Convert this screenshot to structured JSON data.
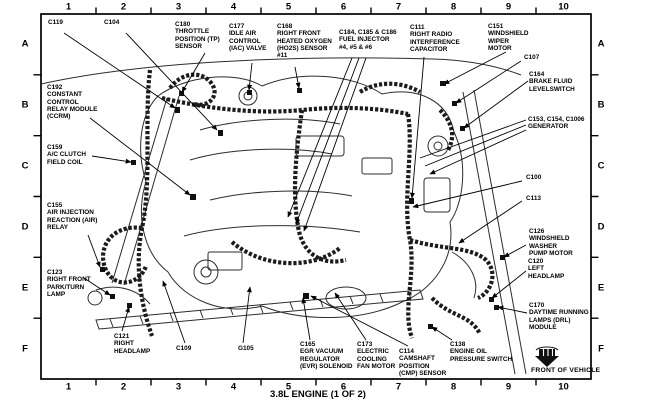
{
  "title": "3.8L ENGINE (1 OF 2)",
  "front_of_vehicle_label": "FRONT OF VEHICLE",
  "colors": {
    "ink": "#000000",
    "background": "#ffffff"
  },
  "grid": {
    "columns": [
      "1",
      "2",
      "3",
      "4",
      "5",
      "6",
      "7",
      "8",
      "9",
      "10"
    ],
    "rows": [
      "A",
      "B",
      "C",
      "D",
      "E",
      "F"
    ]
  },
  "callouts": [
    {
      "id": "c119",
      "text": "C119",
      "x": 48,
      "y": 19
    },
    {
      "id": "c104",
      "text": "C104",
      "x": 104,
      "y": 19
    },
    {
      "id": "c180",
      "text": "C180\nTHROTTLE\nPOSITION (TP)\nSENSOR",
      "x": 175,
      "y": 21
    },
    {
      "id": "c177",
      "text": "C177\nIDLE AIR\nCONTROL\n(IAC) VALVE",
      "x": 229,
      "y": 23
    },
    {
      "id": "c168",
      "text": "C168\nRIGHT FRONT\nHEATED OXYGEN\n(HO2S) SENSOR\n#11",
      "x": 277,
      "y": 23
    },
    {
      "id": "c184-c186",
      "text": "C184, C185 & C186\nFUEL INJECTOR\n#4, #5 & #6",
      "x": 339,
      "y": 29
    },
    {
      "id": "c111",
      "text": "C111\nRIGHT RADIO\nINTERFERENCE\nCAPACITOR",
      "x": 410,
      "y": 24
    },
    {
      "id": "c151",
      "text": "C151\nWINDSHIELD\nWIPER\nMOTOR",
      "x": 488,
      "y": 23
    },
    {
      "id": "c107",
      "text": "C107",
      "x": 524,
      "y": 54
    },
    {
      "id": "c164",
      "text": "C164\nBRAKE FLUID\nLEVELSWITCH",
      "x": 529,
      "y": 71
    },
    {
      "id": "c153-c1006",
      "text": "C153, C154, C1006\nGENERATOR",
      "x": 528,
      "y": 116
    },
    {
      "id": "c100",
      "text": "C100",
      "x": 526,
      "y": 174
    },
    {
      "id": "c113",
      "text": "C113",
      "x": 526,
      "y": 195
    },
    {
      "id": "c126",
      "text": "C126\nWINDSHIELD\nWASHER\nPUMP MOTOR",
      "x": 529,
      "y": 228
    },
    {
      "id": "c120",
      "text": "C120\nLEFT\nHEADLAMP",
      "x": 528,
      "y": 258
    },
    {
      "id": "c170",
      "text": "C170\nDAYTIME RUNNING\nLAMPS (DRL)\nMODULE",
      "x": 529,
      "y": 302
    },
    {
      "id": "c192",
      "text": "C192\nCONSTANT\nCONTROL\nRELAY MODULE\n(CCRM)",
      "x": 47,
      "y": 84
    },
    {
      "id": "c159",
      "text": "C159\nA/C CLUTCH\nFIELD COIL",
      "x": 47,
      "y": 144
    },
    {
      "id": "c155",
      "text": "C155\nAIR INJECTION\nREACTION (AIR)\nRELAY",
      "x": 47,
      "y": 202
    },
    {
      "id": "c123",
      "text": "C123\nRIGHT FRONT\nPARK/TURN\nLAMP",
      "x": 47,
      "y": 269
    },
    {
      "id": "c121",
      "text": "C121\nRIGHT\nHEADLAMP",
      "x": 114,
      "y": 333
    },
    {
      "id": "c109",
      "text": "C109",
      "x": 176,
      "y": 345
    },
    {
      "id": "g105",
      "text": "G105",
      "x": 238,
      "y": 345
    },
    {
      "id": "c165",
      "text": "C165\nEGR VACUUM\nREGULATOR\n(EVR) SOLENOID",
      "x": 300,
      "y": 341
    },
    {
      "id": "c173",
      "text": "C173\nELECTRIC\nCOOLING\nFAN MOTOR",
      "x": 357,
      "y": 341
    },
    {
      "id": "c114",
      "text": "C114\nCAMSHAFT\nPOSITION\n(CMP) SENSOR",
      "x": 399,
      "y": 348
    },
    {
      "id": "c138",
      "text": "C138\nENGINE OIL\nPRESSURE SWITCH",
      "x": 450,
      "y": 341
    }
  ]
}
